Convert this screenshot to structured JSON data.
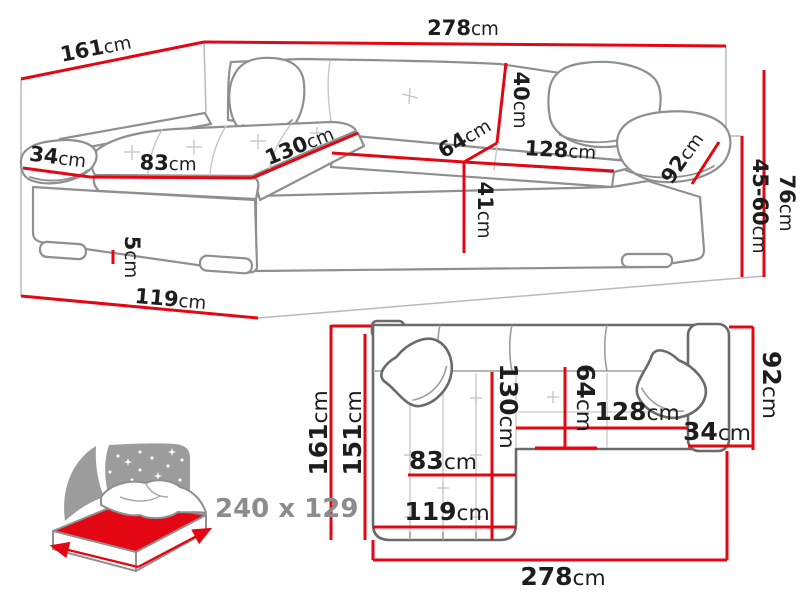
{
  "title": "Corner sofa technical dimensions diagram",
  "colors": {
    "dimension_red": "#e30613",
    "sketch_grey": "#8f8f8f",
    "top_view_outline_grey": "#6a6a6a",
    "label_black": "#1d1d1b",
    "icon_grey": "#9c9c9c",
    "icon_text_grey": "#8c8c8c",
    "background": "#ffffff"
  },
  "front_view": {
    "total_width": {
      "v": "278",
      "u": "cm"
    },
    "total_depth": {
      "v": "161",
      "u": "cm"
    },
    "armrest_width": {
      "v": "34",
      "u": "cm"
    },
    "chaise_seat_width": {
      "v": "83",
      "u": "cm"
    },
    "chaise_seat_length": {
      "v": "130",
      "u": "cm"
    },
    "backrest_height": {
      "v": "40",
      "u": "cm"
    },
    "seat_depth": {
      "v": "64",
      "u": "cm"
    },
    "seat_width": {
      "v": "128",
      "u": "cm"
    },
    "armrest_depth": {
      "v": "92",
      "u": "cm"
    },
    "seat_height": {
      "v": "41",
      "u": "cm"
    },
    "adjustable_height": {
      "v": "45-60",
      "u": "cm"
    },
    "total_height": {
      "v": "76",
      "u": "cm"
    },
    "leg_height": {
      "v": "5",
      "u": "cm"
    },
    "chaise_total_length": {
      "v": "119",
      "u": "cm"
    }
  },
  "top_view": {
    "total_depth_outer": {
      "v": "161",
      "u": "cm"
    },
    "total_depth_inner": {
      "v": "151",
      "u": "cm"
    },
    "armrest_depth": {
      "v": "92",
      "u": "cm"
    },
    "chaise_seat_length": {
      "v": "130",
      "u": "cm"
    },
    "seat_depth": {
      "v": "64",
      "u": "cm"
    },
    "seat_width": {
      "v": "128",
      "u": "cm"
    },
    "armrest_width": {
      "v": "34",
      "u": "cm"
    },
    "chaise_seat_width": {
      "v": "83",
      "u": "cm"
    },
    "chaise_total_length": {
      "v": "119",
      "u": "cm"
    },
    "total_width": {
      "v": "278",
      "u": "cm"
    }
  },
  "sleeping_function": {
    "bed_size": "240 x 129"
  }
}
